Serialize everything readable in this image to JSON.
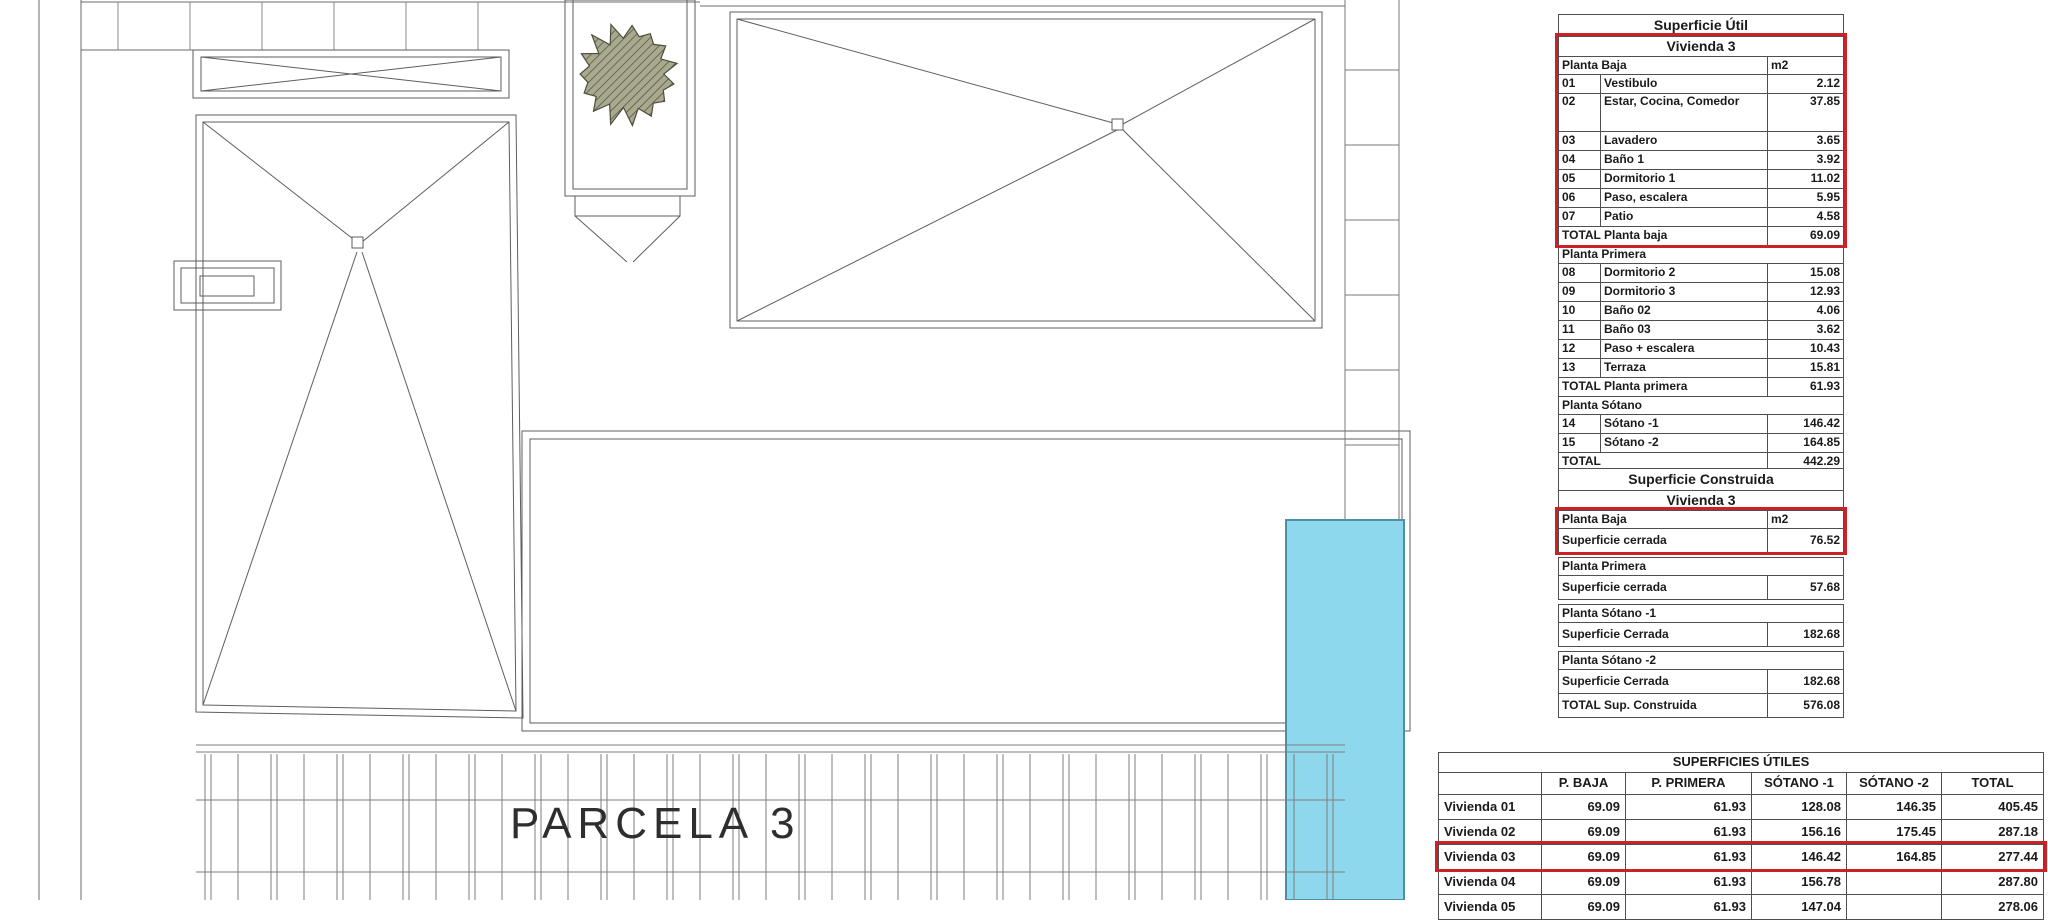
{
  "colors": {
    "highlight_red": "#cc2127",
    "pool_fill": "#8dd8ec",
    "pool_border": "#4e8fa5",
    "drawing_line": "#6b6b6b",
    "table_border": "#4f4f4f"
  },
  "plan": {
    "parcel_label": "PARCELA 3"
  },
  "superficie_util": {
    "title": "Superficie Útil",
    "subtitle": "Vivienda 3",
    "rows": [
      {
        "kind": "section",
        "label": "Planta Baja",
        "value": "m2"
      },
      {
        "kind": "item",
        "num": "01",
        "label": "Vestibulo",
        "value": "2.12"
      },
      {
        "kind": "item",
        "num": "02",
        "label": "Estar, Cocina, Comedor",
        "value": "37.85",
        "tall": true
      },
      {
        "kind": "item",
        "num": "03",
        "label": "Lavadero",
        "value": "3.65"
      },
      {
        "kind": "item",
        "num": "04",
        "label": "Baño 1",
        "value": "3.92"
      },
      {
        "kind": "item",
        "num": "05",
        "label": "Dormitorio 1",
        "value": "11.02"
      },
      {
        "kind": "item",
        "num": "06",
        "label": "Paso, escalera",
        "value": "5.95"
      },
      {
        "kind": "item",
        "num": "07",
        "label": "Patio",
        "value": "4.58"
      },
      {
        "kind": "total",
        "label": "TOTAL Planta baja",
        "value": "69.09"
      },
      {
        "kind": "section",
        "label": "Planta Primera",
        "value": ""
      },
      {
        "kind": "item",
        "num": "08",
        "label": "Dormitorio 2",
        "value": "15.08"
      },
      {
        "kind": "item",
        "num": "09",
        "label": "Dormitorio 3",
        "value": "12.93"
      },
      {
        "kind": "item",
        "num": "10",
        "label": "Baño 02",
        "value": "4.06"
      },
      {
        "kind": "item",
        "num": "11",
        "label": "Baño 03",
        "value": "3.62"
      },
      {
        "kind": "item",
        "num": "12",
        "label": "Paso + escalera",
        "value": "10.43"
      },
      {
        "kind": "item",
        "num": "13",
        "label": "Terraza",
        "value": "15.81"
      },
      {
        "kind": "total",
        "label": "TOTAL Planta primera",
        "value": "61.93"
      },
      {
        "kind": "section",
        "label": "Planta Sótano",
        "value": ""
      },
      {
        "kind": "item",
        "num": "14",
        "label": "Sótano -1",
        "value": "146.42"
      },
      {
        "kind": "item",
        "num": "15",
        "label": "Sótano -2",
        "value": "164.85"
      },
      {
        "kind": "total",
        "label": "TOTAL",
        "value": "442.29"
      }
    ]
  },
  "superficie_construida": {
    "title": "Superficie Construida",
    "subtitle": "Vivienda 3",
    "rows": [
      {
        "kind": "section",
        "label": "Planta Baja",
        "value": "m2"
      },
      {
        "kind": "value",
        "label": "Superficie cerrada",
        "value": "76.52"
      },
      {
        "kind": "gap"
      },
      {
        "kind": "section",
        "label": "Planta Primera",
        "value": ""
      },
      {
        "kind": "value",
        "label": "Superficie cerrada",
        "value": "57.68"
      },
      {
        "kind": "gap"
      },
      {
        "kind": "section",
        "label": "Planta Sótano -1",
        "value": ""
      },
      {
        "kind": "value",
        "label": "Superficie Cerrada",
        "value": "182.68"
      },
      {
        "kind": "gap"
      },
      {
        "kind": "section",
        "label": "Planta Sótano -2",
        "value": ""
      },
      {
        "kind": "value",
        "label": "Superficie Cerrada",
        "value": "182.68"
      },
      {
        "kind": "value",
        "label": "TOTAL Sup. Construida",
        "value": "576.08"
      }
    ]
  },
  "superficies_utiles": {
    "title": "SUPERFICIES ÚTILES",
    "columns": [
      "",
      "P. BAJA",
      "P. PRIMERA",
      "SÓTANO -1",
      "SÓTANO -2",
      "TOTAL"
    ],
    "rows": [
      {
        "label": "Vivienda 01",
        "values": [
          "69.09",
          "61.93",
          "128.08",
          "146.35",
          "405.45"
        ],
        "highlight": false
      },
      {
        "label": "Vivienda 02",
        "values": [
          "69.09",
          "61.93",
          "156.16",
          "175.45",
          "287.18"
        ],
        "highlight": false
      },
      {
        "label": "Vivienda 03",
        "values": [
          "69.09",
          "61.93",
          "146.42",
          "164.85",
          "277.44"
        ],
        "highlight": true
      },
      {
        "label": "Vivienda 04",
        "values": [
          "69.09",
          "61.93",
          "156.78",
          "",
          "287.80"
        ],
        "highlight": false
      },
      {
        "label": "Vivienda 05",
        "values": [
          "69.09",
          "61.93",
          "147.04",
          "",
          "278.06"
        ],
        "highlight": false,
        "clipped": true
      }
    ]
  }
}
